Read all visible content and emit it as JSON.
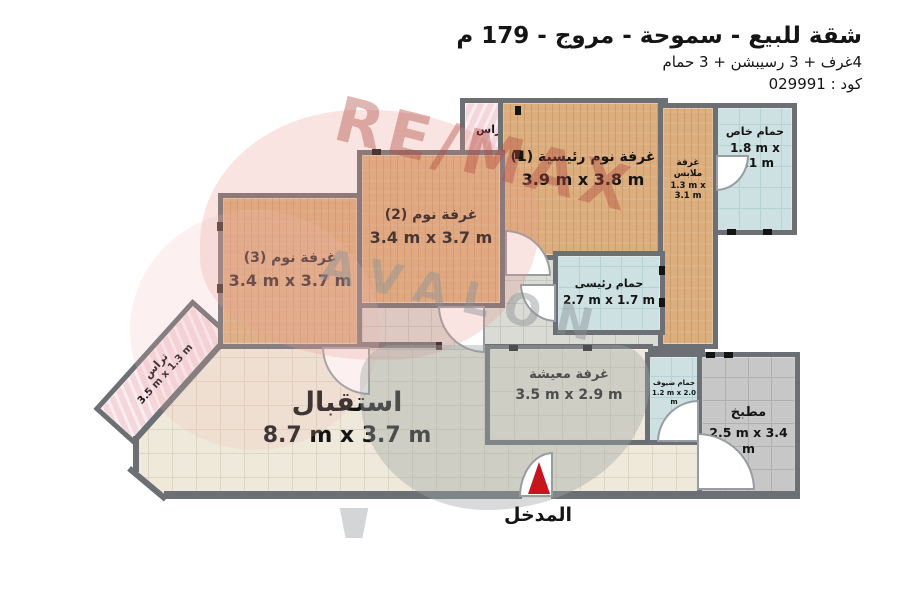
{
  "header": {
    "title": "شقة للبيع - سموحة - مروج - 179 م",
    "subtitle": "4غرف + 3 رسيبشن + 3 حمام",
    "code": "كود : 029991"
  },
  "rooms": {
    "terrace_top": {
      "name": "تراس",
      "dims": ""
    },
    "master_bedroom": {
      "name": "غرفة نوم رئيسية (1)",
      "dims": "3.9 m x 3.8 m"
    },
    "dressing_room": {
      "name": "غرفة ملابس",
      "dims": "1.3 m x 3.1 m"
    },
    "private_bathroom": {
      "name": "حمام خاص",
      "dims": "1.8 m x 3.1 m"
    },
    "bedroom_2": {
      "name": "غرفة نوم (2)",
      "dims": "3.4 m x 3.7 m"
    },
    "bedroom_3": {
      "name": "غرفة نوم (3)",
      "dims": "3.4 m x 3.7 m"
    },
    "main_bathroom": {
      "name": "حمام رئيسى",
      "dims": "2.7 m x 1.7 m"
    },
    "living_room": {
      "name": "غرفة معيشة",
      "dims": "3.5 m x 2.9 m"
    },
    "guest_bathroom": {
      "name": "حمام ضيوف",
      "dims": "1.2 m x 2.0 m"
    },
    "kitchen": {
      "name": "مطبخ",
      "dims": "2.5 m x 3.4 m"
    },
    "reception": {
      "name": "استقبال",
      "dims": "8.7 m x 3.7 m"
    },
    "terrace_left": {
      "name": "تراس",
      "dims": "3.5 m x 1.3 m"
    }
  },
  "entrance": {
    "label": "المدخل"
  },
  "watermark": {
    "brand": "RE/MAX",
    "sub": "AVALON"
  },
  "colors": {
    "wall": "#6c7075",
    "wood_floor": "#dcae7e",
    "bath_tile": "#cde1e2",
    "reception_tile": "#efe9db",
    "kitchen_tile": "#c7c7c7",
    "terrace_pink": "#f4d7dc",
    "entrance_arrow_red": "#c4161c",
    "watermark_red": "#b34a41"
  }
}
